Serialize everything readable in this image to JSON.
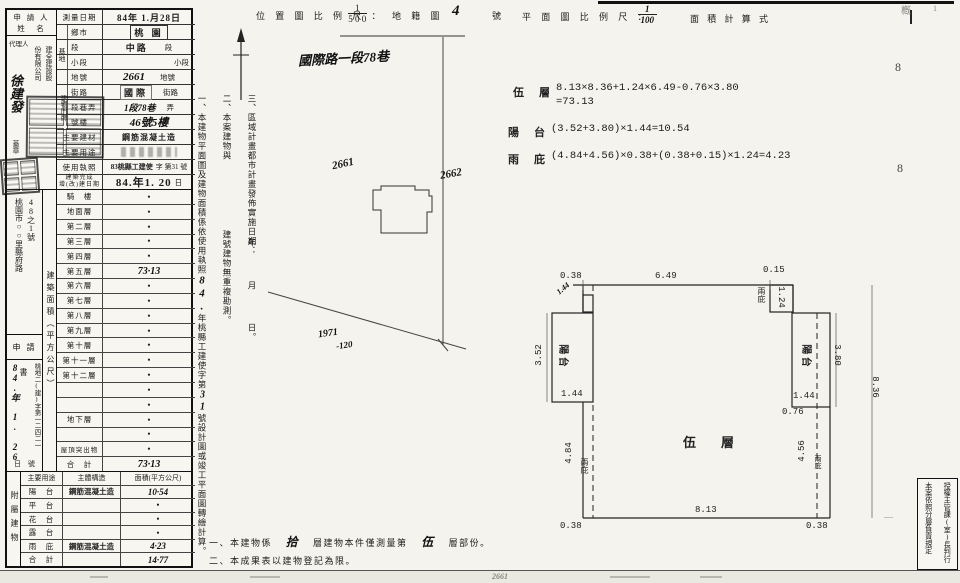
{
  "header": {
    "loc_scale_label": "位 置 圖 比 例 尺 ：",
    "loc_num": "1",
    "loc_den": "5 0 0",
    "cadastre": "地 籍 圖",
    "cadastre_no": "4",
    "cadastre_unit": "號",
    "plan_scale_label": "平 面 圖 比 例 尺 ：",
    "plan_num": "1",
    "plan_den": "100",
    "calc_title": "面 積 計 算 式",
    "corner_mark": "槪",
    "corner_mark2": "1"
  },
  "margin": {
    "m8a": "8",
    "m8b": "8",
    "dash": "—"
  },
  "applicant": {
    "title1": "申 請 人",
    "title2": "姓　名",
    "agent_label": "代理人",
    "company_col_a": "建全建設股",
    "company_col_b": "份有限公司",
    "name": "徐建發",
    "seal": "蓋章"
  },
  "info": {
    "r1l": "測量日期",
    "r1v": "84年 1.月28日",
    "g1": "基地",
    "g2": "建物門牌",
    "r2l": "鄉市",
    "r2v": "桃 園",
    "r3l": "段",
    "r3v_s": "中路",
    "r3v_t": "段",
    "r4l": "小段",
    "r4v": "小段",
    "r5l": "地號",
    "r5v_hw": "2661",
    "r5v_t": "地號",
    "r6l": "街路",
    "r6v_s": "國際",
    "r6v_t": "街路",
    "r7l": "段巷弄",
    "r7v_hw": "1段78巷",
    "r7v_t": "弄",
    "r8l": "號樓",
    "r8v": "46號5樓",
    "r9l": "主要建材",
    "r9v": "鋼筋混凝土造",
    "r10l": "主要用途",
    "r11l": "使用執照",
    "r11v_s": "83桃縣工建使",
    "r11v_t": "字 第31 號",
    "r12la": "建築完成",
    "r12lb": "增(改)建日期",
    "r12v": "84.年1. 20",
    "r12v_t": "日"
  },
  "sidebar": {
    "addr_a": "桃園市○○里縣府路",
    "addr_b": "48之1號",
    "application": "申 請 書",
    "receipt_no": "桃地二(建)字第一二四二一",
    "receipt_date": "84.年 1. 26",
    "receipt_tail": "日　號"
  },
  "area_strip": "建築面積（平方公尺）",
  "floors": [
    {
      "label": "騎　樓",
      "value": "•"
    },
    {
      "label": "地面層",
      "value": "•"
    },
    {
      "label": "第二層",
      "value": "•"
    },
    {
      "label": "第三層",
      "value": "•"
    },
    {
      "label": "第四層",
      "value": "•"
    },
    {
      "label": "第五層",
      "value": "73·13"
    },
    {
      "label": "第六層",
      "value": "•"
    },
    {
      "label": "第七層",
      "value": "•"
    },
    {
      "label": "第八層",
      "value": "•"
    },
    {
      "label": "第九層",
      "value": "•"
    },
    {
      "label": "第十層",
      "value": "•"
    },
    {
      "label": "第十一層",
      "value": "•"
    },
    {
      "label": "第十二層",
      "value": "•"
    },
    {
      "label": "",
      "value": "•"
    },
    {
      "label": "",
      "value": "•"
    },
    {
      "label": "地下層",
      "value": "•"
    },
    {
      "label": "",
      "value": "•"
    },
    {
      "label": "屋頂突出物",
      "value": "•"
    },
    {
      "label": "合　計",
      "value": "73·13"
    }
  ],
  "attach": {
    "side": "附屬建物",
    "h1": "主要用途",
    "h2": "主體構造",
    "h3": "面積(平方公尺)",
    "rows": [
      {
        "c1": "陽　台",
        "c2": "鋼筋混凝土造",
        "c3": "10·54"
      },
      {
        "c1": "平　台",
        "c2": "",
        "c3": "•"
      },
      {
        "c1": "花　台",
        "c2": "",
        "c3": "•"
      },
      {
        "c1": "露　台",
        "c2": "",
        "c3": "•"
      },
      {
        "c1": "雨　庇",
        "c2": "鋼筋混凝土造",
        "c3": "4·23"
      },
      {
        "c1": "合　計",
        "c2": "",
        "c3": "14·77"
      }
    ]
  },
  "vnotes": {
    "n1a": "一、本建物平面圖及建物面積係依使用執照",
    "n1b": "84.",
    "n1c": "年桃縣工建使字第",
    "n1d": "31",
    "n1e": "號設計圖或竣工平面圖轉繪計算。",
    "n2a": "二、本案建物與",
    "n2b": "建號建物無重複勘測。",
    "n3a": "三、區域計畫都市計畫發佈實施日期：",
    "n3b": "年",
    "n3c": "月",
    "n3d": "日。"
  },
  "site": {
    "street": "國際路一段78巷",
    "p1": "2661",
    "p2": "2662",
    "p3": "1971",
    "p3b": "-120"
  },
  "calc": {
    "r1n": "伍　層",
    "r1e": "8.13×8.36+1.24×6.49-0.76×3.80",
    "r1e2": "=73.13",
    "r2n": "陽　台",
    "r2e": "(3.52+3.80)×1.44=10.54",
    "r3n": "雨　庇",
    "r3e": "(4.84+4.56)×0.38+(0.38+0.15)×1.24=4.23"
  },
  "plan": {
    "floor": "伍　層",
    "d_038a": "0.38",
    "d_649": "6.49",
    "d_015": "0.15",
    "d_124": "1.24",
    "canopy_tr": "兩庇",
    "d_352": "3.52",
    "balcony_l": "陽 台",
    "d_144l": "1.44",
    "d_484": "4.84",
    "canopy_bl": "兩庇",
    "d_038bl": "0.38",
    "d_813": "8.13",
    "d_038br": "0.38",
    "d_456": "4.56",
    "canopy_br": "兩庇",
    "d_076": "0.76",
    "d_144r": "1.44",
    "balcony_r": "陽 台",
    "d_380": "3.80",
    "d_836": "8.36",
    "notch_hw": "1.44"
  },
  "bnotes": {
    "b1a": "一、本建物係",
    "b1hw": "拾",
    "b1b": "層建物本件僅測量第",
    "b1hw2": "伍",
    "b1c": "層部份。",
    "b2": "二、本成果表以建物登記為限。"
  },
  "authbox": {
    "right": "授權主管課(室)長判行",
    "left": "本案依照分層負責規定"
  },
  "footer": {
    "print": "83. 6. 20. 000　張"
  },
  "strip": {
    "f1": "2661"
  }
}
